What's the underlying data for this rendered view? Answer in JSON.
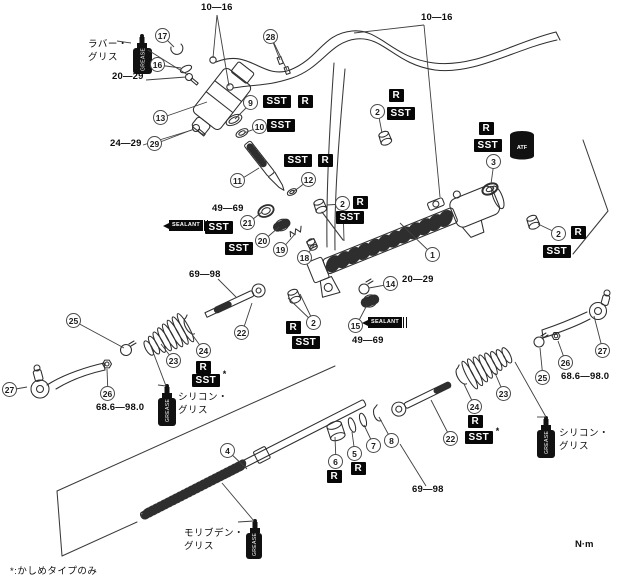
{
  "labels": {
    "sst": "SST",
    "r": "R",
    "sealant": "SEALANT",
    "atf": "ATF",
    "grease": "GREASE",
    "star": "*"
  },
  "misc": {
    "unit": "N·m",
    "footnote": "*:かしめタイプのみ"
  },
  "grease_notes": [
    {
      "name": "rubber-grease-note",
      "text": "ラバー・\nグリス",
      "x": 88,
      "y": 39
    },
    {
      "name": "silicone-grease-left-note",
      "text": "シリコン・\nグリス",
      "x": 178,
      "y": 392
    },
    {
      "name": "silicone-grease-right-note",
      "text": "シリコン・\nグリス",
      "x": 559,
      "y": 428
    },
    {
      "name": "molybdenum-grease-note",
      "text": "モリブデン・\nグリス",
      "x": 184,
      "y": 528
    }
  ],
  "torque_labels": [
    {
      "text": "10—16",
      "x": 201,
      "y": 3,
      "lx": 217,
      "ly": 15,
      "targets": [
        [
          213,
          58
        ],
        [
          229,
          86
        ]
      ]
    },
    {
      "text": "10—16",
      "x": 421,
      "y": 13,
      "lx": 424,
      "ly": 25,
      "targets": [
        [
          354,
          33
        ],
        [
          440,
          197
        ]
      ]
    },
    {
      "text": "20—29",
      "x": 112,
      "y": 72,
      "lx": 146,
      "ly": 80,
      "targets": [
        [
          186,
          77
        ]
      ]
    },
    {
      "text": "24—29",
      "x": 110,
      "y": 139,
      "lx": 143,
      "ly": 145,
      "targets": [
        [
          192,
          130
        ]
      ]
    },
    {
      "text": "49—69",
      "x": 212,
      "y": 204
    },
    {
      "text": "20—29",
      "x": 402,
      "y": 275
    },
    {
      "text": "49—69",
      "x": 352,
      "y": 336
    },
    {
      "text": "69—98",
      "x": 189,
      "y": 270,
      "lx": 218,
      "ly": 279,
      "targets": [
        [
          236,
          297
        ]
      ]
    },
    {
      "text": "68.6—98.0",
      "x": 96,
      "y": 403
    },
    {
      "text": "68.6—98.0",
      "x": 561,
      "y": 372
    },
    {
      "text": "69—98",
      "x": 412,
      "y": 485,
      "lx": 426,
      "ly": 486,
      "targets": [
        [
          400,
          444
        ]
      ]
    }
  ],
  "callouts": [
    {
      "n": "1",
      "x": 433,
      "y": 255,
      "targets": [
        [
          400,
          223
        ]
      ]
    },
    {
      "n": "2",
      "x": 378,
      "y": 112,
      "targets": [
        [
          382,
          133
        ]
      ]
    },
    {
      "n": "2",
      "x": 343,
      "y": 204,
      "targets": [
        [
          327,
          205
        ],
        [
          344,
          241
        ]
      ]
    },
    {
      "n": "2",
      "x": 559,
      "y": 234,
      "targets": [
        [
          538,
          224
        ]
      ]
    },
    {
      "n": "2",
      "x": 314,
      "y": 323,
      "targets": [
        [
          288,
          298
        ],
        [
          300,
          294
        ]
      ]
    },
    {
      "n": "3",
      "x": 494,
      "y": 162,
      "targets": [
        [
          491,
          184
        ]
      ]
    },
    {
      "n": "4",
      "x": 228,
      "y": 451,
      "targets": [
        [
          247,
          469
        ]
      ]
    },
    {
      "n": "5",
      "x": 355,
      "y": 454,
      "targets": [
        [
          352,
          432
        ]
      ]
    },
    {
      "n": "6",
      "x": 336,
      "y": 462,
      "targets": [
        [
          335,
          437
        ]
      ]
    },
    {
      "n": "7",
      "x": 374,
      "y": 446,
      "targets": [
        [
          364,
          425
        ]
      ]
    },
    {
      "n": "8",
      "x": 392,
      "y": 441,
      "targets": [
        [
          379,
          417
        ]
      ]
    },
    {
      "n": "9",
      "x": 251,
      "y": 103,
      "targets": [
        [
          235,
          119
        ]
      ]
    },
    {
      "n": "10",
      "x": 260,
      "y": 127,
      "targets": [
        [
          244,
          133
        ]
      ]
    },
    {
      "n": "11",
      "x": 238,
      "y": 181,
      "targets": [
        [
          259,
          168
        ]
      ]
    },
    {
      "n": "12",
      "x": 309,
      "y": 180,
      "targets": [
        [
          293,
          192
        ]
      ]
    },
    {
      "n": "13",
      "x": 161,
      "y": 118,
      "targets": [
        [
          207,
          102
        ]
      ]
    },
    {
      "n": "14",
      "x": 391,
      "y": 284,
      "targets": [
        [
          369,
          288
        ]
      ]
    },
    {
      "n": "15",
      "x": 356,
      "y": 326,
      "targets": [
        [
          367,
          305
        ]
      ]
    },
    {
      "n": "16",
      "x": 158,
      "y": 65,
      "targets": [
        [
          181,
          68
        ]
      ]
    },
    {
      "n": "17",
      "x": 163,
      "y": 36,
      "targets": [
        [
          174,
          47
        ]
      ]
    },
    {
      "n": "18",
      "x": 305,
      "y": 258,
      "targets": [
        [
          314,
          245
        ]
      ]
    },
    {
      "n": "19",
      "x": 281,
      "y": 250,
      "targets": [
        [
          295,
          234
        ]
      ]
    },
    {
      "n": "20",
      "x": 263,
      "y": 241,
      "targets": [
        [
          279,
          227
        ]
      ]
    },
    {
      "n": "21",
      "x": 248,
      "y": 223,
      "targets": [
        [
          262,
          212
        ]
      ]
    },
    {
      "n": "22",
      "x": 242,
      "y": 333,
      "targets": [
        [
          252,
          303
        ]
      ]
    },
    {
      "n": "22",
      "x": 451,
      "y": 439,
      "targets": [
        [
          431,
          400
        ]
      ]
    },
    {
      "n": "23",
      "x": 174,
      "y": 361,
      "targets": [
        [
          161,
          344
        ]
      ]
    },
    {
      "n": "23",
      "x": 504,
      "y": 394,
      "targets": [
        [
          495,
          373
        ]
      ]
    },
    {
      "n": "24",
      "x": 204,
      "y": 351,
      "targets": [
        [
          191,
          333
        ]
      ]
    },
    {
      "n": "24",
      "x": 475,
      "y": 407,
      "targets": [
        [
          464,
          384
        ]
      ]
    },
    {
      "n": "25",
      "x": 74,
      "y": 321,
      "targets": [
        [
          124,
          348
        ]
      ]
    },
    {
      "n": "25",
      "x": 543,
      "y": 378,
      "targets": [
        [
          540,
          348
        ]
      ]
    },
    {
      "n": "26",
      "x": 108,
      "y": 394,
      "targets": [
        [
          107,
          369
        ]
      ]
    },
    {
      "n": "26",
      "x": 566,
      "y": 363,
      "targets": [
        [
          558,
          341
        ]
      ]
    },
    {
      "n": "27",
      "x": 10,
      "y": 390,
      "targets": [
        [
          27,
          387
        ]
      ]
    },
    {
      "n": "27",
      "x": 603,
      "y": 351,
      "targets": [
        [
          594,
          316
        ]
      ]
    },
    {
      "n": "28",
      "x": 271,
      "y": 37,
      "targets": [
        [
          280,
          60
        ],
        [
          287,
          70
        ]
      ]
    },
    {
      "n": "29",
      "x": 155,
      "y": 144,
      "targets": [
        [
          194,
          129
        ]
      ]
    }
  ],
  "tags": [
    {
      "k": "sst",
      "x": 263,
      "y": 95
    },
    {
      "k": "r",
      "x": 298,
      "y": 95
    },
    {
      "k": "sst",
      "x": 267,
      "y": 119
    },
    {
      "k": "r",
      "x": 389,
      "y": 89
    },
    {
      "k": "sst",
      "x": 387,
      "y": 107
    },
    {
      "k": "sst",
      "x": 284,
      "y": 154
    },
    {
      "k": "r",
      "x": 318,
      "y": 154
    },
    {
      "k": "r",
      "x": 479,
      "y": 122
    },
    {
      "k": "sst",
      "x": 474,
      "y": 139
    },
    {
      "k": "r",
      "x": 353,
      "y": 196
    },
    {
      "k": "sst",
      "x": 336,
      "y": 211
    },
    {
      "k": "r",
      "x": 571,
      "y": 226
    },
    {
      "k": "sst",
      "x": 543,
      "y": 245
    },
    {
      "k": "sst",
      "x": 205,
      "y": 221
    },
    {
      "k": "sst",
      "x": 225,
      "y": 242
    },
    {
      "k": "r",
      "x": 286,
      "y": 321
    },
    {
      "k": "sst",
      "x": 292,
      "y": 336
    },
    {
      "k": "r",
      "x": 196,
      "y": 361
    },
    {
      "k": "sst",
      "x": 192,
      "y": 374,
      "star": true
    },
    {
      "k": "r",
      "x": 468,
      "y": 415
    },
    {
      "k": "sst",
      "x": 465,
      "y": 431,
      "star": true
    },
    {
      "k": "r",
      "x": 327,
      "y": 470
    },
    {
      "k": "r",
      "x": 351,
      "y": 462
    }
  ],
  "sealant_tags": [
    {
      "name": "sealant-tag-left",
      "x": 163,
      "y": 220
    },
    {
      "name": "sealant-tag-right",
      "x": 362,
      "y": 317
    }
  ]
}
